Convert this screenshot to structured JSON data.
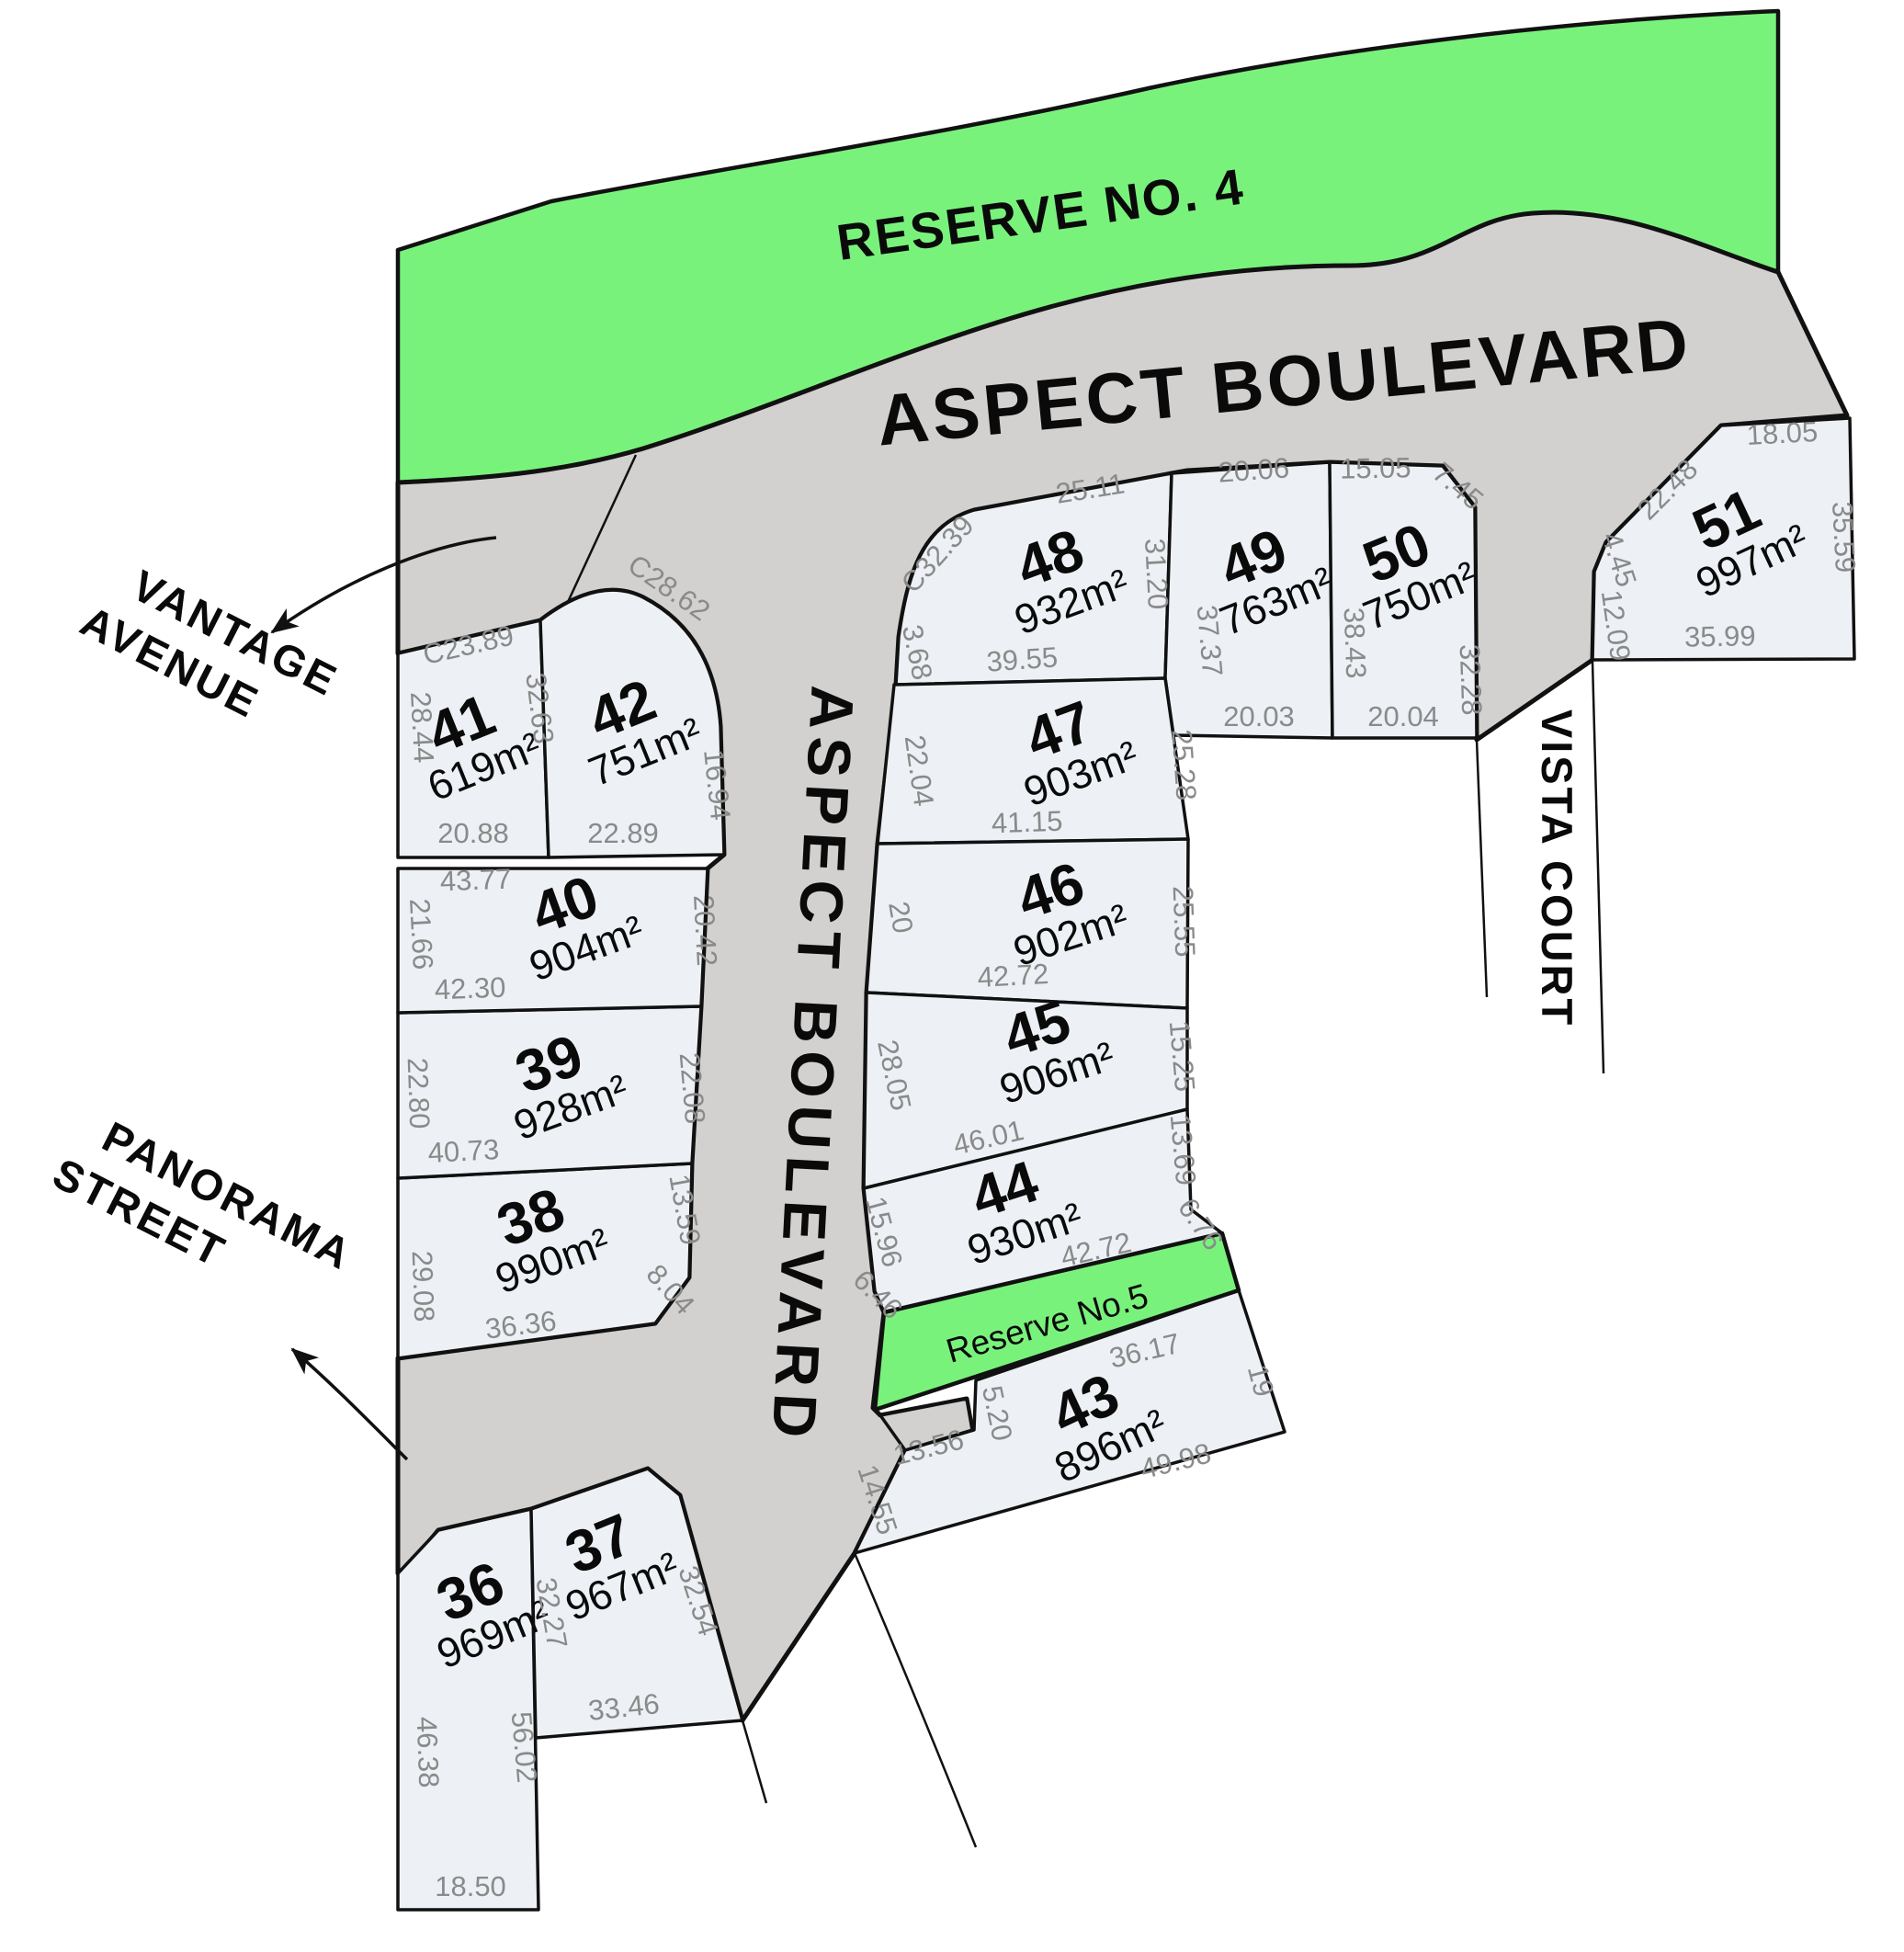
{
  "colors": {
    "reserve_green": "#79F27C",
    "road_gray": "#D2D1CF",
    "lot_fill": "#EDF1F5",
    "dim_text": "#8a8a8a",
    "outline": "#111111"
  },
  "streets": {
    "aspect_top": "ASPECT BOULEVARD",
    "aspect_vertical": "ASPECT BOULEVARD",
    "vista": "VISTA COURT",
    "vantage_line1": "VANTAGE",
    "vantage_line2": "AVENUE",
    "panorama_line1": "PANORAMA",
    "panorama_line2": "STREET"
  },
  "reserves": {
    "reserve4": "RESERVE NO. 4",
    "reserve5": "Reserve No.5"
  },
  "lots": {
    "36": {
      "number": "36",
      "area": "969m²",
      "dims": [
        "46.38",
        "56.02",
        "18.50"
      ]
    },
    "37": {
      "number": "37",
      "area": "967m²",
      "dims": [
        "32.27",
        "32.54",
        "33.46"
      ]
    },
    "38": {
      "number": "38",
      "area": "990m²",
      "dims": [
        "29.08",
        "13.59",
        "8.04",
        "36.36"
      ]
    },
    "39": {
      "number": "39",
      "area": "928m²",
      "dims": [
        "22.80",
        "22.08",
        "40.73"
      ]
    },
    "40": {
      "number": "40",
      "area": "904m²",
      "dims": [
        "43.77",
        "21.66",
        "20.42",
        "42.30"
      ]
    },
    "41": {
      "number": "41",
      "area": "619m²",
      "dims": [
        "C23.89",
        "28.44",
        "32.63",
        "20.88"
      ]
    },
    "42": {
      "number": "42",
      "area": "751m²",
      "dims": [
        "C28.62",
        "16.94",
        "22.89"
      ]
    },
    "43": {
      "number": "43",
      "area": "896m²",
      "dims": [
        "36.17",
        "19",
        "49.98",
        "5.20",
        "13.56",
        "14.55"
      ]
    },
    "44": {
      "number": "44",
      "area": "930m²",
      "dims": [
        "15.96",
        "13.69",
        "6.76",
        "42.72",
        "6.46"
      ]
    },
    "45": {
      "number": "45",
      "area": "906m²",
      "dims": [
        "28.05",
        "15.25",
        "46.01"
      ]
    },
    "46": {
      "number": "46",
      "area": "902m²",
      "dims": [
        "20",
        "25.55",
        "42.72"
      ]
    },
    "47": {
      "number": "47",
      "area": "903m²",
      "dims": [
        "22.04",
        "25.28",
        "41.15"
      ]
    },
    "48": {
      "number": "48",
      "area": "932m²",
      "dims": [
        "C32.39",
        "25.11",
        "31.20",
        "3.68",
        "39.55"
      ]
    },
    "49": {
      "number": "49",
      "area": "763m²",
      "dims": [
        "20.06",
        "37.37",
        "20.03"
      ]
    },
    "50": {
      "number": "50",
      "area": "750m²",
      "dims": [
        "15.05",
        "7.45",
        "38.43",
        "32.28",
        "20.04"
      ]
    },
    "51": {
      "number": "51",
      "area": "997m²",
      "dims": [
        "18.05",
        "22.48",
        "4.45",
        "12.09",
        "35.59",
        "35.99"
      ]
    }
  }
}
